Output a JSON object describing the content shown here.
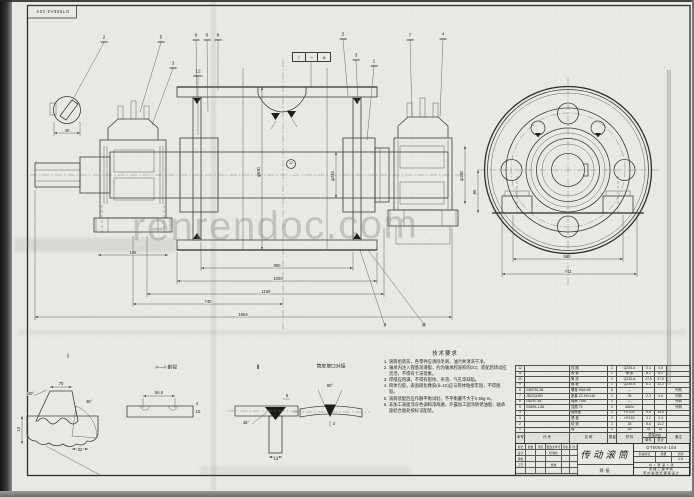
{
  "corner_label": "DTⅡ05A4-104",
  "watermark": "renrendoc.com",
  "weld_symbol": [
    "/",
    "~",
    "a"
  ],
  "callouts": [
    {
      "n": "2",
      "x": 104,
      "y": 42,
      "tx": 72,
      "ty": 101
    },
    {
      "n": "5",
      "x": 161,
      "y": 42,
      "tx": 140,
      "ty": 112
    },
    {
      "n": "9",
      "x": 196,
      "y": 40,
      "tx": 197,
      "ty": 97
    },
    {
      "n": "6",
      "x": 207,
      "y": 40,
      "tx": 208,
      "ty": 112
    },
    {
      "n": "8",
      "x": 218,
      "y": 40,
      "tx": 218,
      "ty": 90
    },
    {
      "n": "3",
      "x": 173,
      "y": 68,
      "tx": 152,
      "ty": 125
    },
    {
      "n": "12",
      "x": 198,
      "y": 76,
      "tx": 198,
      "ty": 135
    },
    {
      "n": "2",
      "x": 343,
      "y": 39,
      "tx": 348,
      "ty": 96
    },
    {
      "n": "7",
      "x": 410,
      "y": 40,
      "tx": 412,
      "ty": 117
    },
    {
      "n": "3",
      "x": 356,
      "y": 60,
      "tx": 358,
      "ty": 104
    },
    {
      "n": "1",
      "x": 374,
      "y": 66,
      "tx": 367,
      "ty": 140
    },
    {
      "n": "4",
      "x": 443,
      "y": 39,
      "tx": 440,
      "ty": 117
    }
  ],
  "labels": [
    {
      "t": "Ⅰ",
      "x": 68,
      "y": 357,
      "fs": 6
    },
    {
      "t": "Ⅱ",
      "x": 258,
      "y": 368,
      "fs": 6
    },
    {
      "t": "A—A 剖视",
      "x": 166,
      "y": 369,
      "fs": 4.8
    },
    {
      "t": "筒皮坡口对接",
      "x": 331,
      "y": 368,
      "fs": 4.8
    },
    {
      "t": "850",
      "x": 277,
      "y": 266
    },
    {
      "t": "1050",
      "x": 278,
      "y": 279
    },
    {
      "t": "1150",
      "x": 266,
      "y": 292
    },
    {
      "t": "740",
      "x": 208,
      "y": 302
    },
    {
      "t": "1854",
      "x": 243,
      "y": 315
    },
    {
      "t": "165",
      "x": 133,
      "y": 253
    },
    {
      "t": "φ630",
      "x": 259,
      "y": 172,
      "rot": true
    },
    {
      "t": "φ245",
      "x": 333,
      "y": 176,
      "rot": true
    },
    {
      "t": "φ180",
      "x": 462,
      "y": 176,
      "rot": true
    },
    {
      "t": "560",
      "x": 567,
      "y": 257
    },
    {
      "t": "742",
      "x": 568,
      "y": 272
    },
    {
      "t": "95",
      "x": 475,
      "y": 192,
      "rot": true
    },
    {
      "t": "40",
      "x": 67,
      "y": 131
    },
    {
      "t": "70",
      "x": 61,
      "y": 384
    },
    {
      "t": "40°",
      "x": 31,
      "y": 394
    },
    {
      "t": "45°",
      "x": 89,
      "y": 402
    },
    {
      "t": "32",
      "x": 80,
      "y": 450
    },
    {
      "t": "10",
      "x": 19,
      "y": 429,
      "rot": true
    },
    {
      "t": "56.5",
      "x": 159,
      "y": 393
    },
    {
      "t": "4",
      "x": 197,
      "y": 404
    },
    {
      "t": "10",
      "x": 198,
      "y": 412
    },
    {
      "t": "45°",
      "x": 246,
      "y": 423
    },
    {
      "t": "6",
      "x": 287,
      "y": 396
    },
    {
      "t": "14",
      "x": 276,
      "y": 459
    },
    {
      "t": "60°",
      "x": 330,
      "y": 386
    },
    {
      "t": "2",
      "x": 334,
      "y": 424
    },
    {
      "t": "12",
      "x": 291,
      "y": 164,
      "fs": 3.6
    },
    {
      "t": "Ⅱ",
      "x": 385,
      "y": 326,
      "fs": 5
    },
    {
      "t": "Ⅲ",
      "x": 424,
      "y": 326,
      "fs": 5
    }
  ],
  "tech": {
    "title": "技术要求",
    "items": [
      "滚筒组装前，各零件应清除毛刺、油污并清洗干净。",
      "轴承内注入锂基润滑脂，约为轴承腔容积的2/3；装配后转动应灵活，不得有卡滞现象。",
      "焊缝应饱满，不得有裂纹、夹渣、气孔等缺陷。",
      "筒体包胶，表面硫化橡胶(δ=10)应与筒体粘接牢固，不得脱胶。",
      "滚筒装配后应作静平衡试验，不平衡量不大于0.5kg·m。",
      "非加工表面涂灰色调和漆两遍，外露加工面涂防锈油脂；轴承座结合面处按标记配装。"
    ]
  },
  "bom": {
    "headers": [
      "序号",
      "代  号",
      "名  称",
      "数量",
      "材  料",
      "单件",
      "总计",
      "备注"
    ],
    "weight_header": "重量(kg)",
    "rows": [
      {
        "no": "12",
        "code": "",
        "name": "挡 圈",
        "qty": "2",
        "mat": "Q235-A",
        "unit": "0.4",
        "total": "0.8",
        "note": ""
      },
      {
        "no": "11",
        "code": "",
        "name": "胶 板",
        "qty": "1",
        "mat": "橡 胶",
        "unit": "8.2",
        "total": "8.2",
        "note": ""
      },
      {
        "no": "10",
        "code": "",
        "name": "筒 皮",
        "qty": "1",
        "mat": "Q235-A",
        "unit": "27.5",
        "total": "27.5",
        "note": ""
      },
      {
        "no": "9",
        "code": "",
        "name": "辐 板",
        "qty": "2",
        "mat": "Q235-A",
        "unit": "6.1",
        "total": "12.2",
        "note": ""
      },
      {
        "no": "8",
        "code": "GB5782-86",
        "name": "螺栓 M16×50",
        "qty": "8",
        "mat": "—",
        "unit": "",
        "total": "",
        "note": "外购"
      },
      {
        "no": "7",
        "code": "JB/ZQ4390",
        "name": "胀套 Z2-90×130",
        "qty": "2",
        "mat": "35",
        "unit": "2.3",
        "total": "4.6",
        "note": "外购"
      },
      {
        "no": "6",
        "code": "GB297-84",
        "name": "轴承 7516",
        "qty": "2",
        "mat": "—",
        "unit": "",
        "total": "",
        "note": "外购"
      },
      {
        "no": "5",
        "code": "GB894.1-86",
        "name": "挡圈 75",
        "qty": "2",
        "mat": "65Mn",
        "unit": "",
        "total": "",
        "note": "外购"
      },
      {
        "no": "4",
        "code": "",
        "name": "轴承座",
        "qty": "2",
        "mat": "HT200",
        "unit": "9.8",
        "total": "19.6",
        "note": ""
      },
      {
        "no": "3",
        "code": "",
        "name": "透 盖",
        "qty": "2",
        "mat": "HT150",
        "unit": "1.2",
        "total": "2.4",
        "note": ""
      },
      {
        "no": "2",
        "code": "",
        "name": "轮 毂",
        "qty": "2",
        "mat": "35",
        "unit": "5.6",
        "total": "11.2",
        "note": ""
      },
      {
        "no": "1",
        "code": "",
        "name": "轴",
        "qty": "1",
        "mat": "45",
        "unit": "32",
        "total": "32",
        "note": ""
      }
    ]
  },
  "title_block": {
    "title": "传动滚筒",
    "title_sub": "焊接",
    "drawing_no": "DTⅡ05A4-104",
    "stage_label": "阶段标记",
    "mass_label": "质量",
    "scale_label": "比例",
    "mass": "",
    "scale": "1:5",
    "sheet_info": "共 1 张  第 1 张",
    "org_line1": "机械工程学院",
    "org_line2": "带式输送机课程设计",
    "sig_rows": [
      [
        "标记",
        "处数",
        "分区",
        "更改文件号",
        "签名",
        "年.月.日"
      ],
      [
        "设计",
        "",
        "",
        "标准化",
        "",
        ""
      ],
      [
        "审核",
        "",
        "",
        "",
        "",
        ""
      ],
      [
        "工艺",
        "",
        "",
        "批准",
        "",
        ""
      ],
      [
        "",
        "",
        "",
        "",
        "",
        ""
      ]
    ]
  }
}
